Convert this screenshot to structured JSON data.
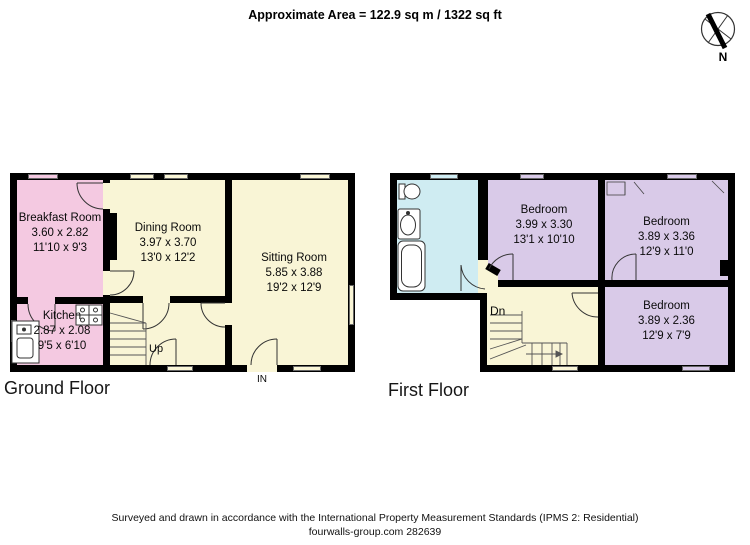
{
  "header": {
    "area_text": "Approximate Area = 122.9 sq m / 1322 sq ft"
  },
  "compass": {
    "north_label": "N"
  },
  "ground_floor": {
    "title": "Ground Floor",
    "entrance_label": "IN",
    "stairs_label": "Up",
    "rooms": [
      {
        "name": "Breakfast Room",
        "size_metric": "3.60 x 2.82",
        "size_imperial": "11'10 x 9'3"
      },
      {
        "name": "Dining Room",
        "size_metric": "3.97 x 3.70",
        "size_imperial": "13'0 x 12'2"
      },
      {
        "name": "Sitting Room",
        "size_metric": "5.85 x 3.88",
        "size_imperial": "19'2 x 12'9"
      },
      {
        "name": "Kitchen",
        "size_metric": "2.87 x 2.08",
        "size_imperial": "9'5 x 6'10"
      }
    ]
  },
  "first_floor": {
    "title": "First Floor",
    "stairs_label": "Dn",
    "rooms": [
      {
        "name": "Bedroom",
        "size_metric": "3.99 x 3.30",
        "size_imperial": "13'1 x 10'10"
      },
      {
        "name": "Bedroom",
        "size_metric": "3.89 x 3.36",
        "size_imperial": "12'9 x 11'0"
      },
      {
        "name": "Bedroom",
        "size_metric": "3.89 x 2.36",
        "size_imperial": "12'9 x 7'9"
      }
    ]
  },
  "footer": {
    "line1": "Surveyed and drawn in accordance with the International Property Measurement Standards (IPMS 2: Residential)",
    "line2": "fourwalls-group.com 282639"
  },
  "colors": {
    "wall": "#000000",
    "cream": "#f9f5d6",
    "pink": "#f4c9e1",
    "cyan": "#cfecf2",
    "purple": "#d9cae8"
  }
}
